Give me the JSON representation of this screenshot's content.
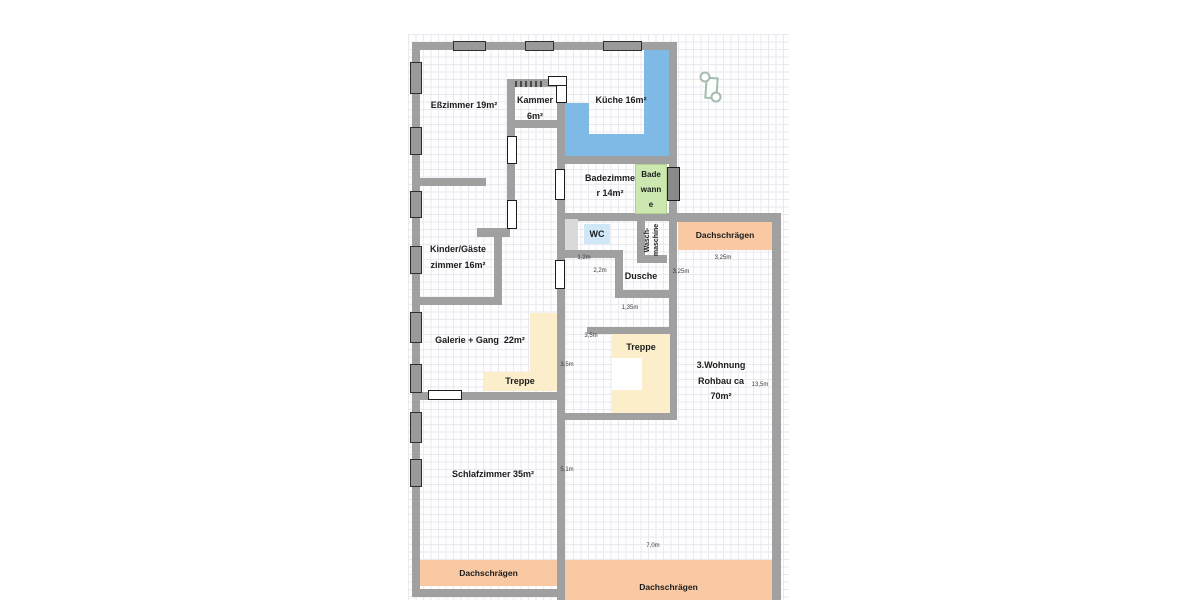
{
  "colors": {
    "wall": "#a0a0a0",
    "window_fill": "#9a9a9a",
    "window_border": "#2f2f2f",
    "counter_blue": "#7fb9e6",
    "bathtub_green": "#cde7b0",
    "wc_blue": "#cfe7f7",
    "stairs_cream": "#fdeecb",
    "roof_orange": "#f9c9a4",
    "door_dark": "#8a8a8a",
    "gray_block": "#d9d9d9",
    "grid": "#e9e9f1",
    "text": "#1c1c1c",
    "dim_text": "#3c3c3c",
    "door_icon": "#a3bcae"
  },
  "rooms": {
    "esszimmer": "Eßzimmer 19m²",
    "kammer_l1": "Kammer",
    "kammer_l2": "6m²",
    "kueche": "Küche 16m²",
    "badezimmer_l1": "Badezimme",
    "badezimmer_l2": "r 14m²",
    "badewanne_l1": "Bade",
    "badewanne_l2": "wann",
    "badewanne_l3": "e",
    "wc": "WC",
    "waschmaschine_l1": "Wasch-",
    "waschmaschine_l2": "maschine",
    "dusche": "Dusche",
    "kinder_l1": "Kinder/Gäste",
    "kinder_l2": "zimmer 16m²",
    "galerie": "Galerie + Gang  22m²",
    "treppe_galerie": "Treppe",
    "treppe_mitte": "Treppe",
    "wohnung3_l1": "3.Wohnung",
    "wohnung3_l2": "Rohbau ca",
    "wohnung3_l3": "70m²",
    "schlafzimmer": "Schlafzimmer 35m²",
    "dach_oben": "Dachschrägen",
    "dach_links": "Dachschrägen",
    "dach_unten": "Dachschrägen"
  },
  "dimensions": {
    "flur_breite": "1,2m",
    "flur_laenge": "2,2m",
    "dusche_rechts": "3,25m",
    "dach_oben_breite": "3,25m",
    "flur_unten": "1,35m",
    "treppe_oben": "3,5m",
    "treppe_links": "3,5m",
    "schlaf_hoehe": "5,1m",
    "wohnung_breite": "7,0m",
    "wohnung_hoehe": "13,5m"
  },
  "icons": {
    "door_symbol": "door-symbol-icon"
  }
}
